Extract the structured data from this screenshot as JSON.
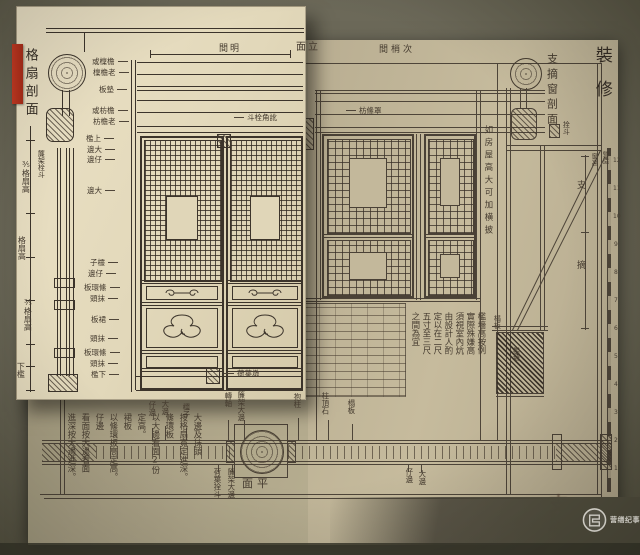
{
  "colors": {
    "background": "#6b6858",
    "page_paper": "#b7ac90",
    "inset_paper": "#e2d8ba",
    "ink": "#4a4136",
    "bookmark_red": "#b9331f",
    "watermark_text": "#ffffff"
  },
  "inset": {
    "title": "格扇剖面",
    "bay_label": "間明",
    "annotations": [
      {
        "n": "inset-side-title",
        "t": "格扇剖面",
        "x": 23,
        "y": 48,
        "v": true,
        "s": 13,
        "ls": 5,
        "c": "inkdark"
      },
      {
        "n": "lianjia-note",
        "t": "簾架栓斗",
        "x": 37,
        "y": 150,
        "v": true,
        "s": 7
      },
      {
        "n": "dim-upper",
        "t": "⅗格扇高",
        "x": 21,
        "y": 160,
        "v": true,
        "s": 8
      },
      {
        "n": "dim-mid",
        "t": "格扇高",
        "x": 17,
        "y": 236,
        "v": true,
        "s": 8
      },
      {
        "n": "dim-lower",
        "t": "⅗格扇高",
        "x": 23,
        "y": 298,
        "v": true,
        "s": 8
      },
      {
        "n": "dim-bottom-sill",
        "t": "下檻",
        "x": 16,
        "y": 362,
        "v": true,
        "s": 8
      },
      {
        "n": "bay-label",
        "t": "間明",
        "x": 219,
        "y": 45,
        "s": 9,
        "ls": 2
      },
      {
        "n": "part-label-purlin-1",
        "t": "或檁檐",
        "x": 92,
        "y": 58,
        "s": 7.5,
        "c": "arr"
      },
      {
        "n": "part-label-purlin-2",
        "t": "檁檐老",
        "x": 93,
        "y": 69,
        "s": 7.5,
        "c": "arr"
      },
      {
        "n": "part-label-dianban",
        "t": "板墊",
        "x": 99,
        "y": 86,
        "s": 7.5,
        "c": "arr"
      },
      {
        "n": "part-label-fang-1",
        "t": "或枋檐",
        "x": 92,
        "y": 107,
        "s": 7.5,
        "c": "arr"
      },
      {
        "n": "part-label-fang-2",
        "t": "枋檐老",
        "x": 93,
        "y": 118,
        "s": 7.5,
        "c": "arr"
      },
      {
        "n": "part-label-shangkan",
        "t": "檻上",
        "x": 86,
        "y": 135,
        "s": 7.5,
        "c": "arr"
      },
      {
        "n": "part-label-dabian-1",
        "t": "邊大",
        "x": 87,
        "y": 146,
        "s": 7.5,
        "c": "arr"
      },
      {
        "n": "part-label-zibian-1",
        "t": "邊仔",
        "x": 87,
        "y": 156,
        "s": 7.5,
        "c": "arr"
      },
      {
        "n": "part-label-dabian-2",
        "t": "邊大",
        "x": 87,
        "y": 187,
        "s": 7.5,
        "c": "arr"
      },
      {
        "n": "part-label-lingzi",
        "t": "子欞",
        "x": 90,
        "y": 259,
        "s": 7.5,
        "c": "arr"
      },
      {
        "n": "part-label-zibian-2",
        "t": "邊仔",
        "x": 88,
        "y": 270,
        "s": 7.5,
        "c": "arr"
      },
      {
        "n": "part-label-taohuanban-1",
        "t": "板環絛",
        "x": 84,
        "y": 284,
        "s": 7.5,
        "c": "arr"
      },
      {
        "n": "part-label-motou-1",
        "t": "頭抹",
        "x": 90,
        "y": 295,
        "s": 7.5,
        "c": "arr"
      },
      {
        "n": "part-label-qunban",
        "t": "板裙",
        "x": 91,
        "y": 316,
        "s": 7.5,
        "c": "arr"
      },
      {
        "n": "part-label-motou-2",
        "t": "頭抹",
        "x": 90,
        "y": 335,
        "s": 7.5,
        "c": "arr"
      },
      {
        "n": "part-label-taohuanban-2",
        "t": "板環絛",
        "x": 84,
        "y": 349,
        "s": 7.5,
        "c": "arr"
      },
      {
        "n": "part-label-motou-3",
        "t": "頭抹",
        "x": 90,
        "y": 360,
        "s": 7.5,
        "c": "arr"
      },
      {
        "n": "part-label-xiakan",
        "t": "檻下",
        "x": 91,
        "y": 371,
        "s": 7.5,
        "c": "arr"
      },
      {
        "n": "corner-pin-label",
        "t": "斗栓角訛",
        "x": 234,
        "y": 114,
        "s": 7.5,
        "c": "arrl"
      },
      {
        "n": "heyedun-label",
        "t": "荷葉墩",
        "x": 224,
        "y": 370,
        "s": 7.5,
        "c": "arrl"
      }
    ]
  },
  "main": {
    "elevation_title": "面立",
    "bays_label": "間梢次",
    "plate_title": "裝修",
    "section_title": "支摘窗剖面",
    "annotations": [
      {
        "n": "elevation-title",
        "t": "面立",
        "x": 296,
        "y": 43,
        "s": 10,
        "ls": 2
      },
      {
        "n": "bays-label",
        "t": "間梢次",
        "x": 379,
        "y": 46,
        "s": 9,
        "ls": 3
      },
      {
        "n": "band-label",
        "t": "枋絛罩",
        "x": 346,
        "y": 107,
        "s": 7.5,
        "c": "arrl"
      },
      {
        "n": "pin-label",
        "t": "拴斗",
        "x": 562,
        "y": 121,
        "v": true,
        "s": 7
      },
      {
        "n": "section-title",
        "t": "支摘窗剖面",
        "x": 546,
        "y": 53,
        "v": true,
        "s": 11,
        "ls": 4
      },
      {
        "n": "plate-title",
        "t": "裝修",
        "x": 592,
        "y": 46,
        "v": true,
        "s": 17,
        "ls": 17,
        "c": "inkdark"
      },
      {
        "n": "transom-note",
        "t": "如房屋高大可加横披",
        "x": 483,
        "y": 125,
        "v": true,
        "s": 8.5,
        "ls": 4
      },
      {
        "n": "dim-zhi",
        "t": "支",
        "x": 577,
        "y": 182,
        "s": 9
      },
      {
        "n": "dim-zhai",
        "t": "摘",
        "x": 577,
        "y": 262,
        "s": 9
      },
      {
        "n": "dim-chuanggao",
        "t": "窗高",
        "x": 590,
        "y": 153,
        "v": true,
        "s": 6.5
      },
      {
        "n": "dim-yingzao",
        "t": "營造",
        "x": 601,
        "y": 151,
        "v": true,
        "s": 6.5
      },
      {
        "n": "wall-label-taban",
        "t": "榻板",
        "x": 493,
        "y": 315,
        "v": true,
        "s": 7
      },
      {
        "n": "wall-label-kanqiang",
        "t": "檻墻",
        "x": 512,
        "y": 347,
        "v": true,
        "s": 7
      },
      {
        "n": "note-right-col1",
        "t": "檻墻高按例",
        "x": 476,
        "y": 312,
        "v": true,
        "s": 8.5
      },
      {
        "n": "note-right-col2",
        "t": "實際殊嫌高",
        "x": 465,
        "y": 312,
        "v": true,
        "s": 8.5
      },
      {
        "n": "note-right-col3",
        "t": "須視室內炕",
        "x": 454,
        "y": 312,
        "v": true,
        "s": 8.5
      },
      {
        "n": "note-right-col4",
        "t": "由設計人酌",
        "x": 443,
        "y": 312,
        "v": true,
        "s": 8.5
      },
      {
        "n": "note-right-col5",
        "t": "定以在二尺",
        "x": 432,
        "y": 312,
        "v": true,
        "s": 8.5
      },
      {
        "n": "note-right-col6",
        "t": "五寸至三尺",
        "x": 421,
        "y": 312,
        "v": true,
        "s": 8.5
      },
      {
        "n": "note-right-col7",
        "t": "之間為宜",
        "x": 410,
        "y": 312,
        "v": true,
        "s": 8.5
      },
      {
        "n": "ruler-number",
        "t": "12",
        "x": 613,
        "y": 158,
        "s": 6,
        "c": "num"
      },
      {
        "n": "ruler-number",
        "t": "11",
        "x": 613,
        "y": 186,
        "s": 6,
        "c": "num"
      },
      {
        "n": "ruler-number",
        "t": "10",
        "x": 613,
        "y": 214,
        "s": 6,
        "c": "num"
      },
      {
        "n": "ruler-number",
        "t": "9",
        "x": 614,
        "y": 242,
        "s": 6,
        "c": "num"
      },
      {
        "n": "ruler-number",
        "t": "8",
        "x": 614,
        "y": 270,
        "s": 6,
        "c": "num"
      },
      {
        "n": "ruler-number",
        "t": "7",
        "x": 614,
        "y": 298,
        "s": 6,
        "c": "num"
      },
      {
        "n": "ruler-number",
        "t": "6",
        "x": 614,
        "y": 326,
        "s": 6,
        "c": "num"
      },
      {
        "n": "ruler-number",
        "t": "5",
        "x": 614,
        "y": 354,
        "s": 6,
        "c": "num"
      },
      {
        "n": "ruler-number",
        "t": "4",
        "x": 614,
        "y": 382,
        "s": 6,
        "c": "num"
      },
      {
        "n": "ruler-number",
        "t": "3",
        "x": 614,
        "y": 410,
        "s": 6,
        "c": "num"
      },
      {
        "n": "ruler-number",
        "t": "2",
        "x": 614,
        "y": 438,
        "s": 6,
        "c": "num"
      },
      {
        "n": "ruler-number",
        "t": "1",
        "x": 614,
        "y": 466,
        "s": 6,
        "c": "num"
      }
    ]
  },
  "plan": {
    "title": "面平",
    "annotations": [
      {
        "n": "plan-title",
        "t": "面平",
        "x": 242,
        "y": 478,
        "s": 11,
        "ls": 4
      },
      {
        "n": "plan-label-zibian-l",
        "t": "仔邊",
        "x": 148,
        "y": 401,
        "v": true,
        "s": 7.5
      },
      {
        "n": "plan-label-dabian-l",
        "t": "大邊",
        "x": 161,
        "y": 400,
        "v": true,
        "s": 7.5
      },
      {
        "n": "plan-label-lingzi",
        "t": "欞子",
        "x": 182,
        "y": 403,
        "v": true,
        "s": 7.5
      },
      {
        "n": "plan-label-zhuanzhou",
        "t": "轉軸",
        "x": 224,
        "y": 392,
        "v": true,
        "s": 7.5
      },
      {
        "n": "plan-label-lianjiadabian-top",
        "t": "簾架大邊",
        "x": 237,
        "y": 391,
        "v": true,
        "s": 7.5
      },
      {
        "n": "plan-label-baozhu",
        "t": "抱柱",
        "x": 293,
        "y": 393,
        "v": true,
        "s": 7.5
      },
      {
        "n": "plan-label-zhudingshi",
        "t": "柱頂石",
        "x": 321,
        "y": 392,
        "v": true,
        "s": 7.5
      },
      {
        "n": "plan-label-taban",
        "t": "榻板",
        "x": 347,
        "y": 399,
        "v": true,
        "s": 7.5
      },
      {
        "n": "plan-label-heyeshuandou",
        "t": "荷葉拴斗",
        "x": 213,
        "y": 468,
        "v": true,
        "s": 7.5
      },
      {
        "n": "plan-label-lianjiadabian-bottom",
        "t": "簾架大邊",
        "x": 227,
        "y": 468,
        "v": true,
        "s": 7.5
      },
      {
        "n": "plan-label-zibian-r",
        "t": "仔邊",
        "x": 405,
        "y": 468,
        "v": true,
        "s": 7.5
      },
      {
        "n": "plan-label-dabian-r",
        "t": "大邊",
        "x": 418,
        "y": 470,
        "v": true,
        "s": 7.5
      },
      {
        "n": "note-left-col1",
        "t": "大邊及抹頭",
        "x": 192,
        "y": 413,
        "v": true,
        "s": 8.5
      },
      {
        "n": "note-left-col2",
        "t": "按格扇寬定進深。",
        "x": 178,
        "y": 413,
        "v": true,
        "s": 8.5
      },
      {
        "n": "note-left-col3",
        "t": "絛環板",
        "x": 164,
        "y": 413,
        "v": true,
        "s": 8.5
      },
      {
        "n": "note-left-col4",
        "t": "以大邊看面2份",
        "x": 150,
        "y": 413,
        "v": true,
        "s": 8.5
      },
      {
        "n": "note-left-col5",
        "t": "定高。",
        "x": 136,
        "y": 413,
        "v": true,
        "s": 8.5
      },
      {
        "n": "note-left-col6",
        "t": "裙板",
        "x": 122,
        "y": 413,
        "v": true,
        "s": 8.5
      },
      {
        "n": "note-left-col7",
        "t": "以絛環板高定高。",
        "x": 108,
        "y": 413,
        "v": true,
        "s": 8.5
      },
      {
        "n": "note-left-col8",
        "t": "仔邊",
        "x": 94,
        "y": 413,
        "v": true,
        "s": 8.5
      },
      {
        "n": "note-left-col9",
        "t": "看面按大邊看面",
        "x": 80,
        "y": 413,
        "v": true,
        "s": 8.5
      },
      {
        "n": "note-left-col10",
        "t": "進深按大邊進深。",
        "x": 66,
        "y": 413,
        "v": true,
        "s": 8.5
      }
    ]
  },
  "misc": {
    "annotations": [
      {
        "n": "pageedge-bleed-text",
        "t": "支牕",
        "x": 546,
        "y": 494,
        "v": true,
        "s": 19,
        "c": "faint"
      }
    ]
  },
  "watermark": {
    "text": "营缮纪事"
  }
}
